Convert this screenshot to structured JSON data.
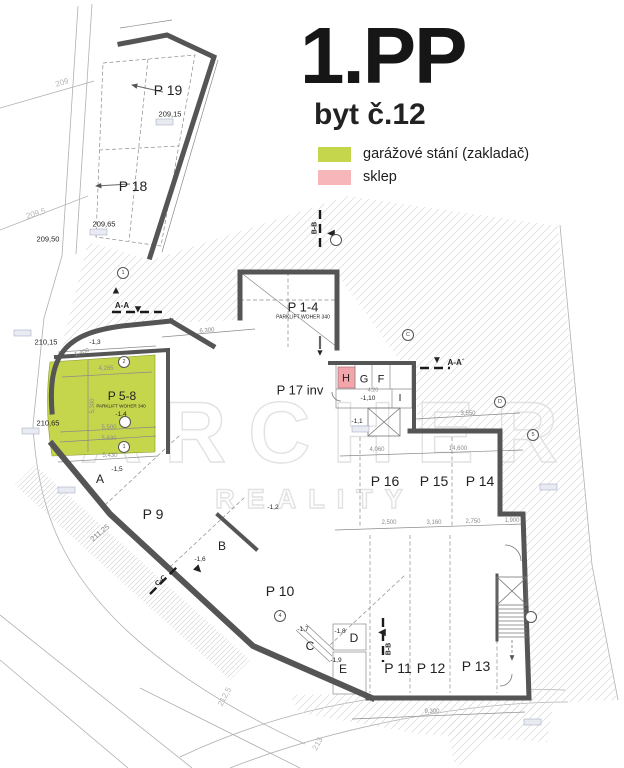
{
  "title": {
    "floor": "1.PP",
    "unit": "byt č.12"
  },
  "legend": {
    "items": [
      {
        "label": "garážové stání (zakladač)",
        "color": "#c5d64c"
      },
      {
        "label": "sklep",
        "color": "#f6b6ba"
      }
    ]
  },
  "watermark": {
    "line1": "ARCHER",
    "line2": "REALITY"
  },
  "colors": {
    "wall": "#555555",
    "hatch": "#dadada",
    "dim": "#8c8c8c",
    "cellar_fill": "#f2a6ab"
  },
  "plan": {
    "labels": [
      {
        "n": "room-p19",
        "t": "P 19",
        "x": 168,
        "y": 90,
        "s": 14
      },
      {
        "n": "room-p18",
        "t": "P 18",
        "x": 133,
        "y": 186,
        "s": 14
      },
      {
        "n": "elev-209-15",
        "t": "209,15",
        "x": 170,
        "y": 114,
        "s": 7.5
      },
      {
        "n": "elev-209-65",
        "t": "209,65",
        "x": 104,
        "y": 224,
        "s": 7.5
      },
      {
        "n": "elev-209-50",
        "t": "209,50",
        "x": 48,
        "y": 239,
        "s": 7.5
      },
      {
        "n": "contour-209",
        "t": "209",
        "x": 62,
        "y": 83,
        "s": 8,
        "rot": -17,
        "c": "#b5b5b5"
      },
      {
        "n": "contour-209-5",
        "t": "209,5",
        "x": 36,
        "y": 214,
        "s": 8,
        "rot": -17,
        "c": "#b5b5b5"
      },
      {
        "n": "elev-210-15",
        "t": "210,15",
        "x": 46,
        "y": 342,
        "s": 7.5
      },
      {
        "n": "elev-210-65",
        "t": "210,65",
        "x": 48,
        "y": 423,
        "s": 7.5
      },
      {
        "n": "elev-211-25",
        "t": "211,25",
        "x": 100,
        "y": 533,
        "s": 7.5,
        "rot": -40,
        "c": "#888888"
      },
      {
        "n": "contour-212-5",
        "t": "212,5",
        "x": 225,
        "y": 697,
        "s": 8,
        "rot": -62,
        "c": "#b5b5b5"
      },
      {
        "n": "contour-213",
        "t": "213",
        "x": 318,
        "y": 744,
        "s": 8,
        "rot": -62,
        "c": "#b5b5b5"
      },
      {
        "n": "room-p1-4",
        "t": "P 1-4",
        "x": 303,
        "y": 307,
        "s": 13
      },
      {
        "n": "room-p1-4-sub",
        "t": "PARKLIFT WOHER 340",
        "x": 303,
        "y": 318,
        "s": 5
      },
      {
        "n": "room-p17-inv",
        "t": "P 17 inv",
        "x": 300,
        "y": 390,
        "s": 13
      },
      {
        "n": "cell-h",
        "t": "H",
        "x": 346,
        "y": 379,
        "s": 11
      },
      {
        "n": "cell-g",
        "t": "G",
        "x": 364,
        "y": 380,
        "s": 11
      },
      {
        "n": "cell-f",
        "t": "F",
        "x": 381,
        "y": 380,
        "s": 11
      },
      {
        "n": "level-1-10",
        "t": "-1,10",
        "x": 368,
        "y": 399,
        "s": 6.5
      },
      {
        "n": "cell-i",
        "t": "I",
        "x": 400,
        "y": 399,
        "s": 10
      },
      {
        "n": "level-1-1",
        "t": "-1,1",
        "x": 357,
        "y": 422,
        "s": 6.5
      },
      {
        "n": "room-p16",
        "t": "P 16",
        "x": 385,
        "y": 481,
        "s": 14
      },
      {
        "n": "room-p15",
        "t": "P 15",
        "x": 434,
        "y": 481,
        "s": 14
      },
      {
        "n": "room-p14",
        "t": "P 14",
        "x": 480,
        "y": 481,
        "s": 14
      },
      {
        "n": "room-p5-8",
        "t": "P 5-8",
        "x": 122,
        "y": 396,
        "s": 12
      },
      {
        "n": "room-p5-8-sub",
        "t": "PARKLIFT WOHER 340",
        "x": 121,
        "y": 407,
        "s": 4.6
      },
      {
        "n": "level-1-4",
        "t": "-1,4",
        "x": 121,
        "y": 415,
        "s": 6.5
      },
      {
        "n": "level-1-3",
        "t": "-1,3",
        "x": 95,
        "y": 343,
        "s": 6.5
      },
      {
        "n": "room-a",
        "t": "A",
        "x": 100,
        "y": 479,
        "s": 12
      },
      {
        "n": "level-1-5",
        "t": "-1,5",
        "x": 117,
        "y": 470,
        "s": 6.5
      },
      {
        "n": "room-p9",
        "t": "P 9",
        "x": 153,
        "y": 514,
        "s": 14
      },
      {
        "n": "room-b",
        "t": "B",
        "x": 222,
        "y": 546,
        "s": 12
      },
      {
        "n": "level-1-6",
        "t": "-1,6",
        "x": 200,
        "y": 560,
        "s": 6.5
      },
      {
        "n": "room-p10",
        "t": "P 10",
        "x": 280,
        "y": 591,
        "s": 14
      },
      {
        "n": "level-1-2",
        "t": "-1,2",
        "x": 273,
        "y": 508,
        "s": 6.5
      },
      {
        "n": "room-c",
        "t": "C",
        "x": 310,
        "y": 646,
        "s": 12
      },
      {
        "n": "level-1-7",
        "t": "-1,7",
        "x": 303,
        "y": 630,
        "s": 6.5
      },
      {
        "n": "room-d",
        "t": "D",
        "x": 354,
        "y": 638,
        "s": 12
      },
      {
        "n": "level-1-8",
        "t": "-1,8",
        "x": 340,
        "y": 632,
        "s": 6.5
      },
      {
        "n": "room-e",
        "t": "E",
        "x": 343,
        "y": 669,
        "s": 12
      },
      {
        "n": "level-1-9",
        "t": "-1,9",
        "x": 336,
        "y": 661,
        "s": 6.5
      },
      {
        "n": "room-p11",
        "t": "P 11",
        "x": 398,
        "y": 668,
        "s": 14
      },
      {
        "n": "room-p12",
        "t": "P 12",
        "x": 431,
        "y": 668,
        "s": 14
      },
      {
        "n": "room-p13",
        "t": "P 13",
        "x": 476,
        "y": 666,
        "s": 14
      },
      {
        "n": "section-aa-left",
        "t": "A-A",
        "x": 122,
        "y": 306,
        "s": 8,
        "b": true
      },
      {
        "n": "section-aa-right",
        "t": "A-A´",
        "x": 456,
        "y": 363,
        "s": 8,
        "b": true
      },
      {
        "n": "section-bb-top",
        "t": "B-B",
        "x": 315,
        "y": 228,
        "s": 7,
        "rot": -90,
        "b": true
      },
      {
        "n": "section-bb-bottom",
        "t": "B-B",
        "x": 389,
        "y": 649,
        "s": 7,
        "rot": -90,
        "b": true
      },
      {
        "n": "section-cc",
        "t": "C-C",
        "x": 161,
        "y": 581,
        "s": 7,
        "rot": -42,
        "b": true
      },
      {
        "n": "marker-aa-left-up",
        "t": "▲",
        "x": 116,
        "y": 291,
        "s": 11
      },
      {
        "n": "marker-aa-left-down",
        "t": "▼",
        "x": 138,
        "y": 310,
        "s": 11
      },
      {
        "n": "marker-aa-right",
        "t": "▼",
        "x": 437,
        "y": 361,
        "s": 10
      },
      {
        "n": "marker-bb-top",
        "t": "◀",
        "x": 331,
        "y": 234,
        "s": 10
      },
      {
        "n": "marker-bb-bottom",
        "t": "◀",
        "x": 382,
        "y": 633,
        "s": 10
      },
      {
        "n": "marker-entry",
        "t": "▼",
        "x": 320,
        "y": 353,
        "s": 9
      },
      {
        "n": "marker-cc",
        "t": "▶",
        "x": 198,
        "y": 570,
        "s": 10,
        "rot": 45
      },
      {
        "n": "dim-4265",
        "t": "4,265",
        "x": 106,
        "y": 369,
        "s": 6,
        "c": "#8c8c8c"
      },
      {
        "n": "dim-5300",
        "t": "5,300",
        "x": 93,
        "y": 406,
        "s": 6,
        "rot": -90,
        "c": "#8c8c8c"
      },
      {
        "n": "dim-5500",
        "t": "5,500",
        "x": 109,
        "y": 428,
        "s": 6,
        "c": "#8c8c8c"
      },
      {
        "n": "dim-5630",
        "t": "5,630",
        "x": 109,
        "y": 439,
        "s": 6,
        "c": "#8c8c8c"
      },
      {
        "n": "dim-5430",
        "t": "5,430",
        "x": 110,
        "y": 456,
        "s": 6,
        "c": "#8c8c8c"
      },
      {
        "n": "dim-1400",
        "t": "1,400",
        "x": 82,
        "y": 353,
        "s": 6,
        "rot": -18,
        "c": "#8c8c8c"
      },
      {
        "n": "dim-6300",
        "t": "6,300",
        "x": 207,
        "y": 331,
        "s": 6,
        "rot": -5,
        "c": "#8c8c8c"
      },
      {
        "n": "dim-420",
        "t": "4,20",
        "x": 373,
        "y": 391,
        "s": 5.5,
        "c": "#8c8c8c"
      },
      {
        "n": "dim-3550",
        "t": "3,550",
        "x": 468,
        "y": 414,
        "s": 6,
        "c": "#8c8c8c"
      },
      {
        "n": "dim-4060",
        "t": "4,060",
        "x": 377,
        "y": 450,
        "s": 6,
        "c": "#8c8c8c"
      },
      {
        "n": "dim-14600",
        "t": "14,600",
        "x": 458,
        "y": 449,
        "s": 6,
        "c": "#8c8c8c"
      },
      {
        "n": "dim-2500",
        "t": "2,500",
        "x": 389,
        "y": 523,
        "s": 6,
        "c": "#8c8c8c"
      },
      {
        "n": "dim-3160",
        "t": "3,160",
        "x": 434,
        "y": 523,
        "s": 6,
        "c": "#8c8c8c"
      },
      {
        "n": "dim-2750",
        "t": "2,750",
        "x": 473,
        "y": 522,
        "s": 6,
        "c": "#8c8c8c"
      },
      {
        "n": "dim-1900",
        "t": "1,900",
        "x": 512,
        "y": 521,
        "s": 6,
        "c": "#8c8c8c"
      },
      {
        "n": "dim-9300",
        "t": "9,300",
        "x": 432,
        "y": 712,
        "s": 6,
        "c": "#8c8c8c"
      }
    ],
    "circles": [
      {
        "t": "1",
        "x": 123,
        "y": 273
      },
      {
        "t": "",
        "x": 336,
        "y": 240
      },
      {
        "t": "C",
        "x": 408,
        "y": 335
      },
      {
        "t": "D",
        "x": 500,
        "y": 402
      },
      {
        "t": "5",
        "x": 533,
        "y": 435
      },
      {
        "t": "4",
        "x": 280,
        "y": 616
      },
      {
        "t": "2",
        "x": 124,
        "y": 362
      },
      {
        "t": "1",
        "x": 124,
        "y": 447
      },
      {
        "t": "",
        "x": 125,
        "y": 422
      },
      {
        "t": "",
        "x": 531,
        "y": 617
      }
    ]
  }
}
